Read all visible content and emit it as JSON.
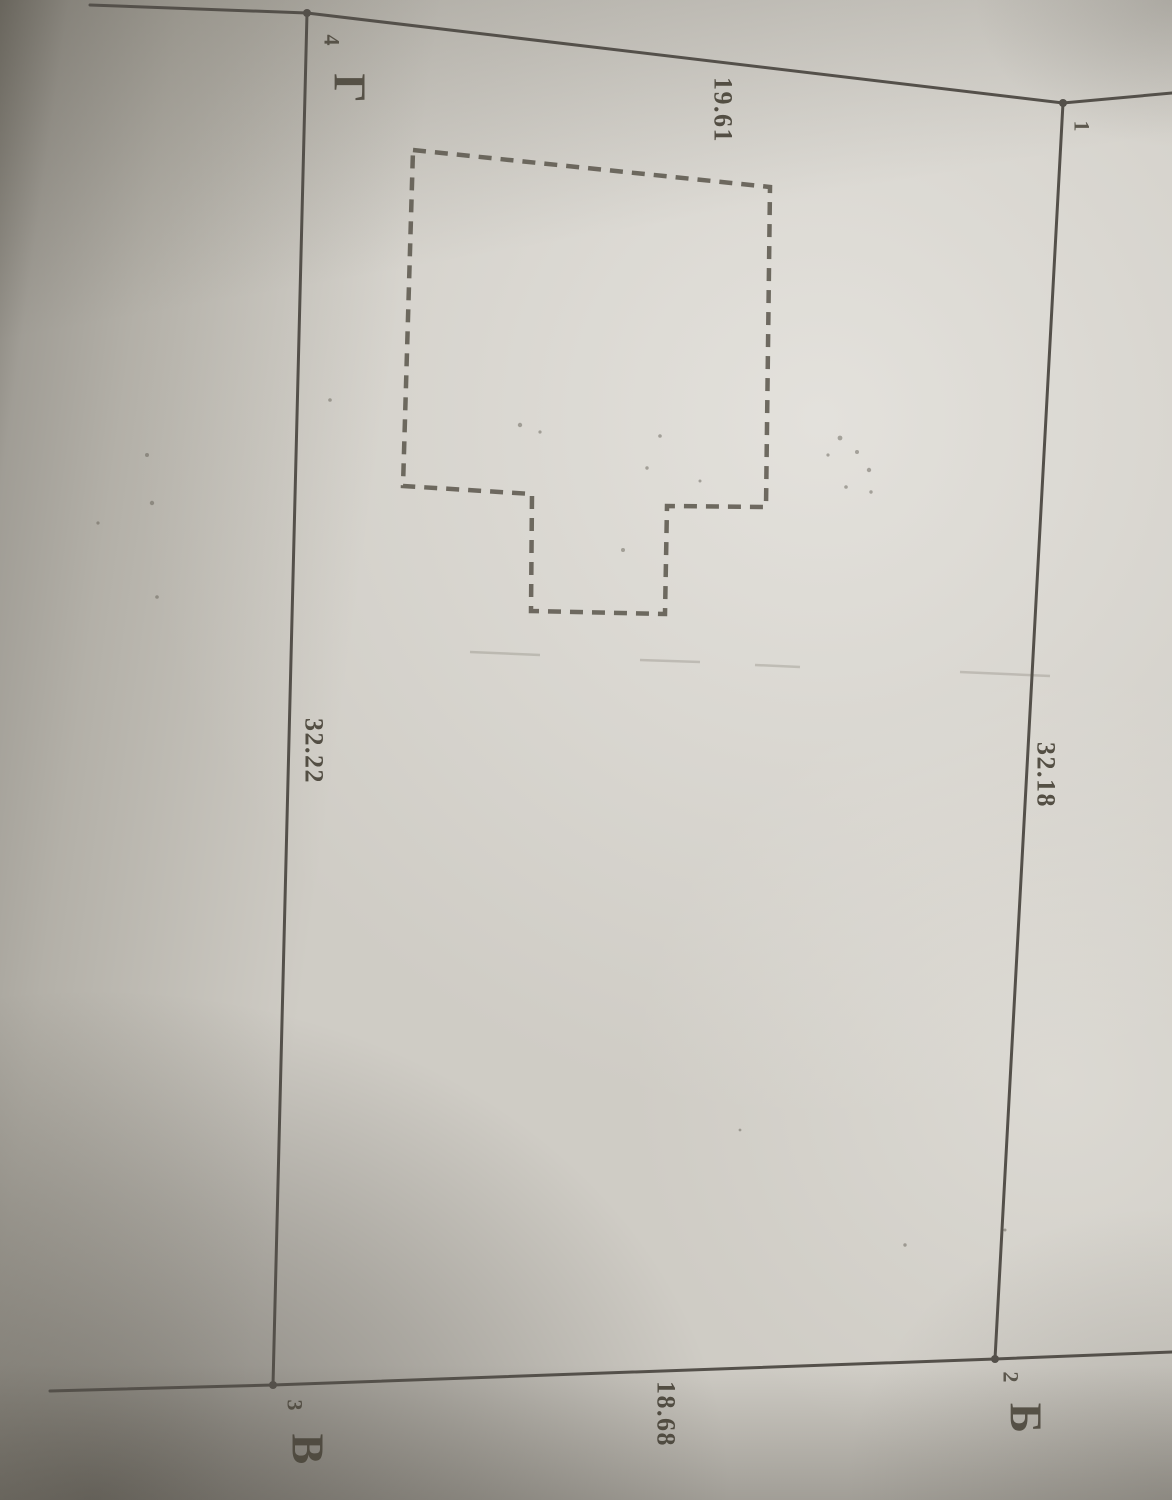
{
  "plan": {
    "corner_points": {
      "p1": "1",
      "p2": "2",
      "p3": "3",
      "p4": "4"
    },
    "adjacent_plot_letters": {
      "near_p2": "Б",
      "near_p3": "В",
      "near_p4": "Г"
    },
    "side_dimensions": {
      "top_4_to_1": "19.61",
      "right_1_to_2": "32.18",
      "left_4_to_3": "32.22",
      "bottom_3_to_2": "18.68"
    },
    "colors": {
      "ink": "#54504a",
      "dashed_ink": "#5d594f",
      "text_ink": "#494439"
    }
  }
}
